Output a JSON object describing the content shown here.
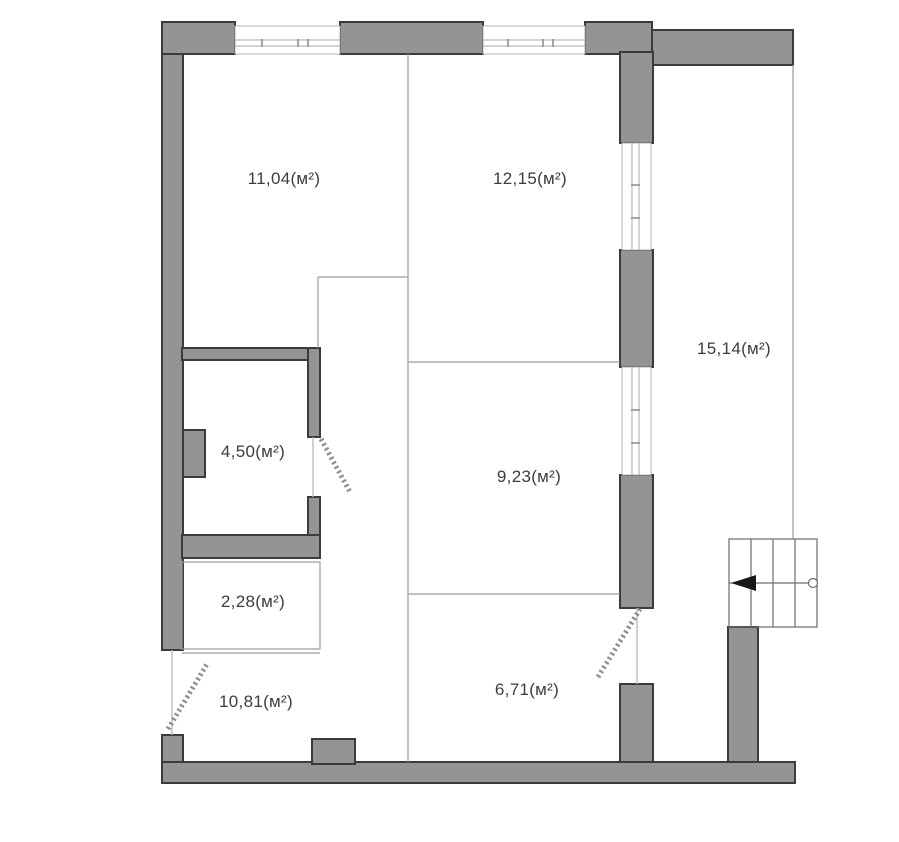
{
  "plan": {
    "units_note": "м²",
    "rooms": [
      {
        "id": "room-top-left",
        "area_label": "11,04(м²)"
      },
      {
        "id": "room-top-right",
        "area_label": "12,15(м²)"
      },
      {
        "id": "balcony-right",
        "area_label": "15,14(м²)"
      },
      {
        "id": "room-bath",
        "area_label": "4,50(м²)"
      },
      {
        "id": "room-middle",
        "area_label": "9,23(м²)"
      },
      {
        "id": "room-closet",
        "area_label": "2,28(м²)"
      },
      {
        "id": "room-bottom-middle",
        "area_label": "6,71(м²)"
      },
      {
        "id": "room-hall",
        "area_label": "10,81(м²)"
      }
    ],
    "colors": {
      "wall_fill": "#949494",
      "wall_edge": "#3b3b3b",
      "thin_line": "#9b9b9b",
      "door_dash": "#8d8d8d",
      "stairs_line": "#6b6b6b",
      "text": "#3d3d3d",
      "background": "#ffffff"
    }
  }
}
